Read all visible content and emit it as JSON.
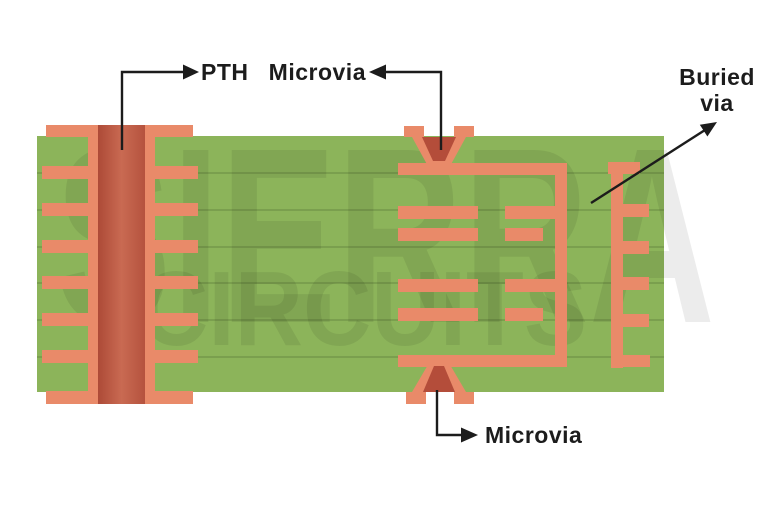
{
  "title": "PCB via types cross-section diagram",
  "labels": {
    "pth": "PTH",
    "microvia_top": "Microvia",
    "buried_line1": "Buried",
    "buried_line2": "via",
    "microvia_bottom": "Microvia"
  },
  "watermark": {
    "line1": "SIERRA",
    "line2": "CIRCUITS",
    "color": "rgba(0,0,0,0.075)"
  },
  "colors": {
    "background": "#ffffff",
    "board": "#8cb45a",
    "layer_line": "#5f7d3c",
    "copper": "#e98a69",
    "via_inner": "#b44d3a",
    "barrel_edge": "#ad4a37",
    "barrel_mid": "#c96a52",
    "barrel_edge2": "#b5523e",
    "annotation": "#1c1c1c"
  }
}
